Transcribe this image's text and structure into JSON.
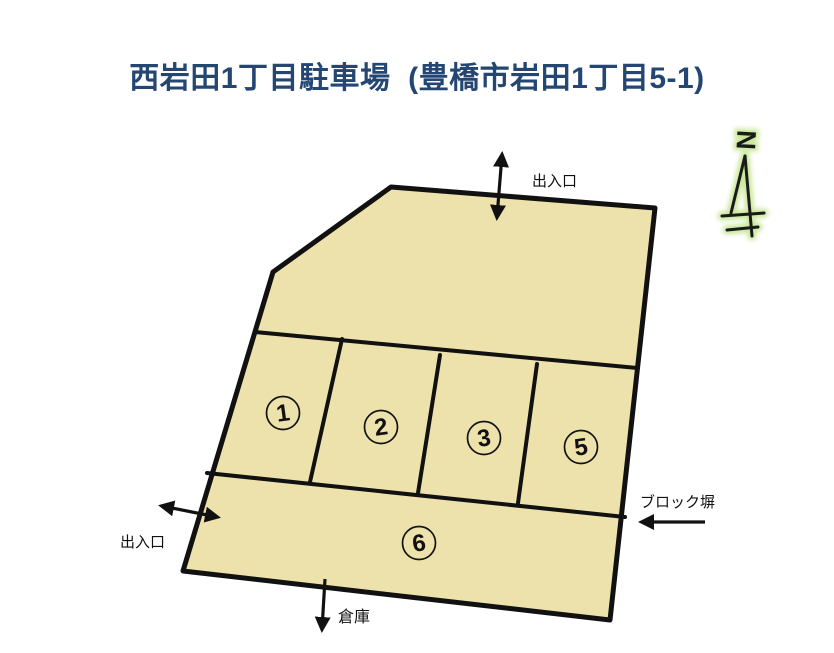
{
  "title": "西岩田1丁目駐車場  (豊橋市岩田1丁目5-1)",
  "colors": {
    "title_text": "#234673",
    "lot_fill": "#EDE2AB",
    "line": "#111111",
    "north_glow": "#C9E79A"
  },
  "labels": {
    "entrance_top": "出入口",
    "entrance_left": "出入口",
    "block_wall": "ブロック塀",
    "warehouse": "倉庫",
    "north": "N"
  },
  "spaces": [
    {
      "number": "1"
    },
    {
      "number": "2"
    },
    {
      "number": "3"
    },
    {
      "number": "5"
    },
    {
      "number": "6"
    }
  ]
}
